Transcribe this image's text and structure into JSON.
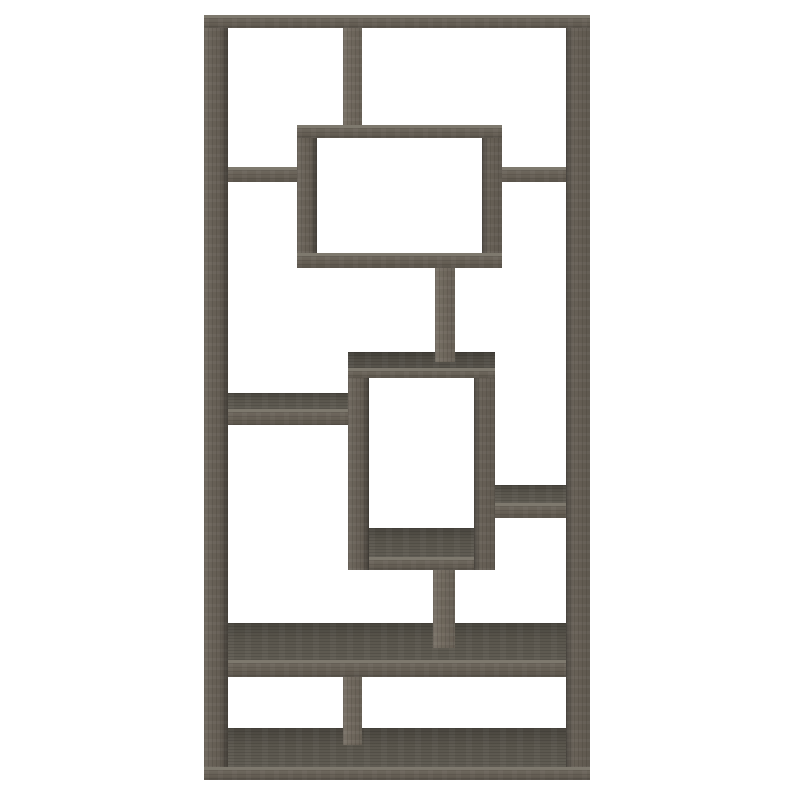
{
  "meta": {
    "type": "product-photo",
    "subject": "10-shelf geometric staggered bookcase, weathered grey finish, front view on white background",
    "finish": "weathered grey",
    "background": "#ffffff"
  },
  "palette": {
    "face": "#665f55",
    "top": "#5a564d",
    "top_dark": "#514d45",
    "edge_highlight": "#7e796e",
    "side_shadow": "#3e3b34"
  },
  "furniture": {
    "canvas": {
      "width": 800,
      "height": 800
    },
    "boards": [
      {
        "name": "outer-left-post",
        "kind": "v-post",
        "x": 204,
        "y": 28,
        "w": 24,
        "h": 739,
        "shade": "right",
        "tone": null
      },
      {
        "name": "outer-right-post",
        "kind": "v-post",
        "x": 566,
        "y": 28,
        "w": 24,
        "h": 739,
        "shade": "left",
        "tone": null
      },
      {
        "name": "outer-top-board",
        "kind": "h-board",
        "x": 204,
        "y": 15,
        "w": 386,
        "h": 13,
        "shade": null,
        "tone": null
      },
      {
        "name": "top-center-divider",
        "kind": "v-post",
        "x": 343,
        "y": 28,
        "w": 19,
        "h": 97,
        "shade": null,
        "tone": "light"
      },
      {
        "name": "upper-box-left-post",
        "kind": "v-post",
        "x": 297,
        "y": 125,
        "w": 20,
        "h": 143,
        "shade": "right",
        "tone": null
      },
      {
        "name": "upper-box-right-post",
        "kind": "v-post",
        "x": 482,
        "y": 125,
        "w": 20,
        "h": 143,
        "shade": "left",
        "tone": null
      },
      {
        "name": "upper-box-top-board",
        "kind": "h-board",
        "x": 297,
        "y": 125,
        "w": 205,
        "h": 13,
        "shade": null,
        "tone": null
      },
      {
        "name": "upper-box-bottom-board",
        "kind": "h-board",
        "x": 297,
        "y": 253,
        "w": 205,
        "h": 15,
        "shade": null,
        "tone": null
      },
      {
        "name": "upper-left-shelf",
        "kind": "h-board",
        "x": 228,
        "y": 167,
        "w": 69,
        "h": 15,
        "shade": null,
        "tone": null
      },
      {
        "name": "upper-right-shelf",
        "kind": "h-board",
        "x": 502,
        "y": 167,
        "w": 64,
        "h": 15,
        "shade": null,
        "tone": null
      },
      {
        "name": "middle-box-left-post",
        "kind": "v-post",
        "x": 348,
        "y": 352,
        "w": 21,
        "h": 218,
        "shade": "right",
        "tone": null
      },
      {
        "name": "middle-box-right-post",
        "kind": "v-post",
        "x": 474,
        "y": 352,
        "w": 21,
        "h": 218,
        "shade": "left",
        "tone": null
      },
      {
        "name": "middle-box-top-surface",
        "kind": "top-surface",
        "x": 348,
        "y": 352,
        "w": 147,
        "h": 16,
        "shade": null,
        "tone": "dark"
      },
      {
        "name": "middle-box-top-face",
        "kind": "h-board",
        "x": 348,
        "y": 368,
        "w": 147,
        "h": 10,
        "shade": null,
        "tone": null
      },
      {
        "name": "center-post-upper",
        "kind": "v-post",
        "x": 435,
        "y": 268,
        "w": 20,
        "h": 94,
        "shade": null,
        "tone": "light"
      },
      {
        "name": "middle-box-interior-floor",
        "kind": "top-surface",
        "x": 369,
        "y": 528,
        "w": 105,
        "h": 29,
        "shade": null,
        "tone": null
      },
      {
        "name": "middle-box-bottom-face",
        "kind": "h-board",
        "x": 369,
        "y": 557,
        "w": 105,
        "h": 13,
        "shade": null,
        "tone": null
      },
      {
        "name": "middle-left-shelf-top",
        "kind": "top-surface",
        "x": 228,
        "y": 393,
        "w": 120,
        "h": 16,
        "shade": null,
        "tone": null
      },
      {
        "name": "middle-left-shelf-face",
        "kind": "h-board",
        "x": 228,
        "y": 409,
        "w": 120,
        "h": 16,
        "shade": null,
        "tone": null
      },
      {
        "name": "middle-right-shelf-top",
        "kind": "top-surface",
        "x": 495,
        "y": 485,
        "w": 71,
        "h": 18,
        "shade": null,
        "tone": null
      },
      {
        "name": "middle-right-shelf-face",
        "kind": "h-board",
        "x": 495,
        "y": 503,
        "w": 71,
        "h": 15,
        "shade": null,
        "tone": null
      },
      {
        "name": "wide-shelf-top",
        "kind": "top-surface",
        "x": 228,
        "y": 623,
        "w": 338,
        "h": 37,
        "shade": null,
        "tone": null
      },
      {
        "name": "wide-shelf-face",
        "kind": "h-board",
        "x": 228,
        "y": 660,
        "w": 338,
        "h": 17,
        "shade": null,
        "tone": null
      },
      {
        "name": "center-post-lower",
        "kind": "v-post",
        "x": 433,
        "y": 570,
        "w": 22,
        "h": 78,
        "shade": null,
        "tone": "light"
      },
      {
        "name": "bottom-shelf-top",
        "kind": "top-surface",
        "x": 228,
        "y": 728,
        "w": 338,
        "h": 39,
        "shade": null,
        "tone": null
      },
      {
        "name": "bottom-divider",
        "kind": "v-post",
        "x": 343,
        "y": 677,
        "w": 19,
        "h": 68,
        "shade": null,
        "tone": "light"
      },
      {
        "name": "outer-bottom-face",
        "kind": "h-board",
        "x": 204,
        "y": 767,
        "w": 386,
        "h": 13,
        "shade": null,
        "tone": null
      }
    ]
  }
}
